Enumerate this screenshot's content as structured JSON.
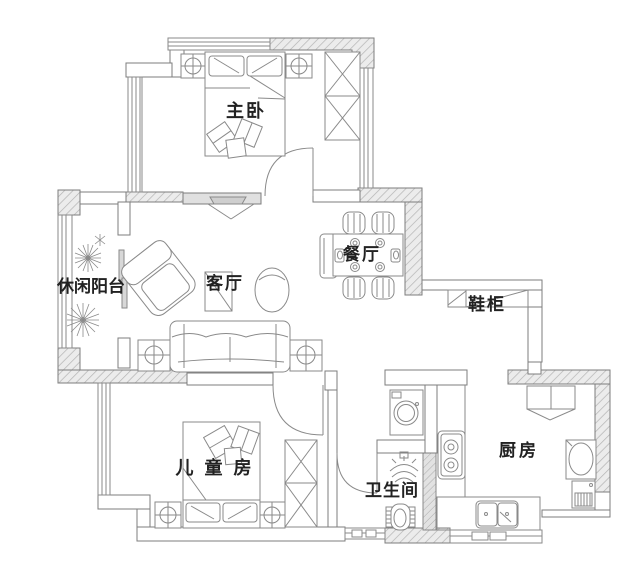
{
  "title": "apartment-floor-plan",
  "rooms": {
    "master_bedroom": {
      "label": "主卧"
    },
    "leisure_balcony": {
      "label": "休闲阳台"
    },
    "living_room": {
      "label": "客厅"
    },
    "dining_room": {
      "label": "餐厅"
    },
    "shoe_cabinet": {
      "label": "鞋柜"
    },
    "kids_room": {
      "label": "儿童房"
    },
    "bathroom": {
      "label": "卫生间"
    },
    "kitchen": {
      "label": "厨房"
    }
  },
  "colors": {
    "background": "#ffffff",
    "line": "#7d7d7d",
    "wall_fill": "#ececec",
    "wall_hatch": "#b3b3b3",
    "grey_wall": "#e0e0e0",
    "label": "#222222"
  }
}
